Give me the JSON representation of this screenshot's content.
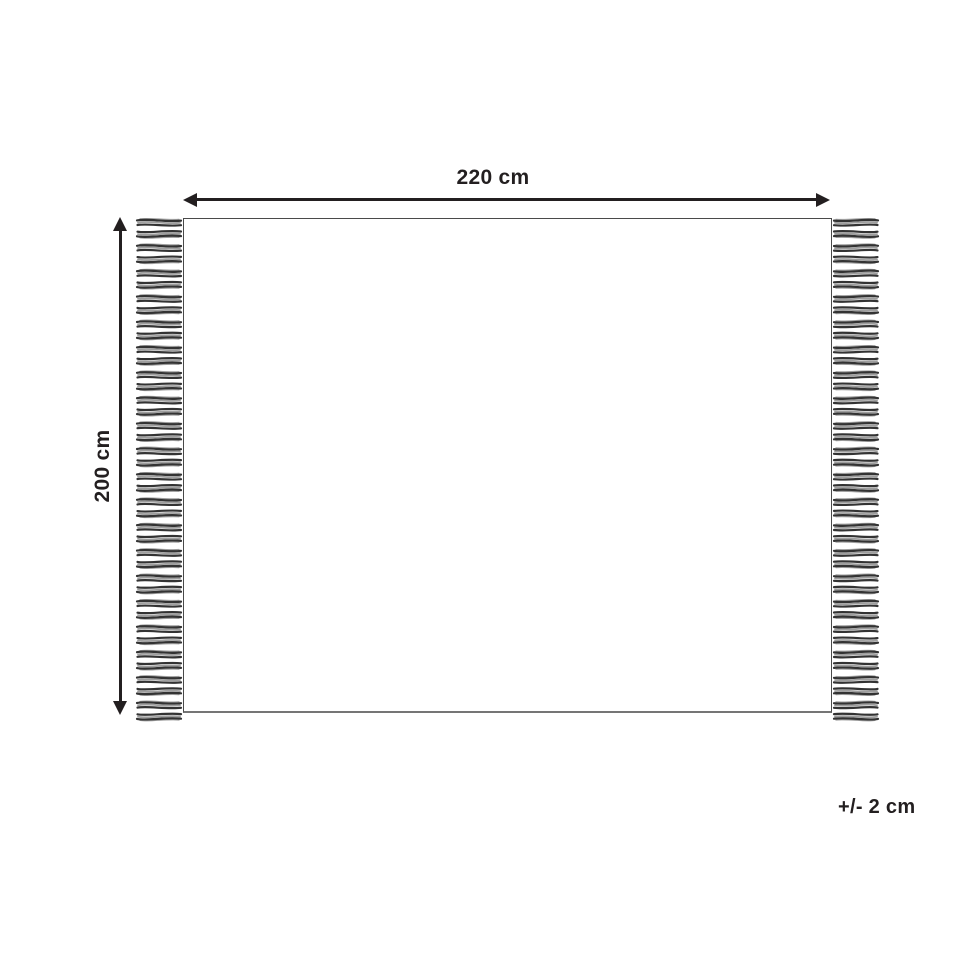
{
  "diagram": {
    "width_dimension": {
      "label": "220 cm"
    },
    "height_dimension": {
      "label": "200 cm"
    },
    "tolerance_note": "+/- 2 cm",
    "fringe": {
      "count_per_side": 40,
      "spacing": 12.7,
      "first_offset": 2,
      "tassel_length": 46,
      "tassel_height": 10
    },
    "colors": {
      "line": "#231f20",
      "text": "#231f20",
      "rug_border": "#4a4a4a",
      "rug_bottom_edge": "#757575",
      "tassel_dark": "#333333",
      "tassel_light": "#9e9e9e",
      "background": "#ffffff"
    }
  }
}
